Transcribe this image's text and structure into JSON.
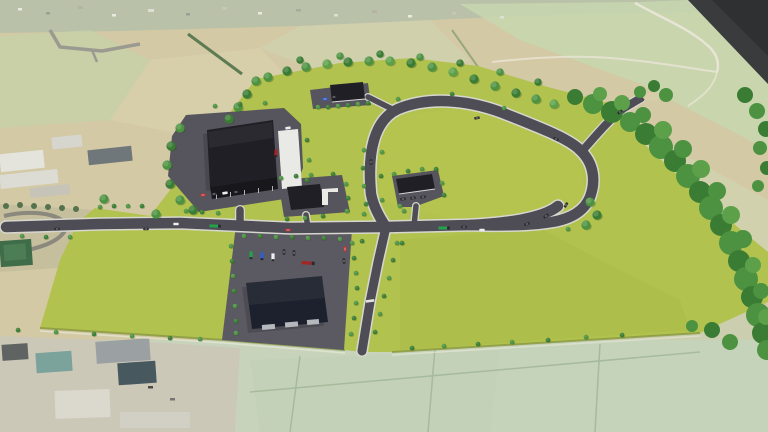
{
  "scene": {
    "kind": "3d-aerial-masterplan-render",
    "site_label": "proposed-business-park-on-farmland",
    "buildings": [
      {
        "id": "hq-warehouse",
        "label": "large warehouse with entrance canopy and loading pad"
      },
      {
        "id": "unit-a",
        "label": "small unit with parking, north parcel"
      },
      {
        "id": "unit-b",
        "label": "small unit with white dock, central parcel"
      },
      {
        "id": "unit-c",
        "label": "small unit with parking, east of crossroads"
      },
      {
        "id": "south-warehouse",
        "label": "large distribution warehouse in truck yard"
      }
    ],
    "roads": [
      "main-access-road",
      "loop-road",
      "south-spine-road",
      "north-east-spur"
    ],
    "vehicles": [
      "semi-trucks",
      "box-trucks",
      "cars"
    ]
  },
  "colors": {
    "aerial_base": "#d4c9a5",
    "aerial_village": "#b9c1a8",
    "aerial_field_green": "#c6d6ae",
    "aerial_pasture": "#c8d3bb",
    "aerial_dark_corner": "#393b3d",
    "aerial_road": "#9b9a90",
    "aerial_path": "#e9e5d6",
    "site_grass": "#b2c24e",
    "road_kerb": "#d7d7cf",
    "road_asphalt": "#4e4d55",
    "pad_asphalt": "#56555d",
    "yard_asphalt": "#5b5a62",
    "roof_dark": "#1f1f25",
    "roof_navy": "#1d212d",
    "white_pad": "#e9e9e5",
    "woodland": "#46823c",
    "tree_dark": "#3a7c33",
    "tree_mid": "#4c9241",
    "tree_light": "#5da04a",
    "truck_green": "#23a14b",
    "truck_blue": "#2f5fd0",
    "truck_white": "#eef0ee",
    "truck_red": "#a32626",
    "car_dark": "#26262c",
    "car_white": "#e9e9e9",
    "car_red": "#c53434"
  }
}
